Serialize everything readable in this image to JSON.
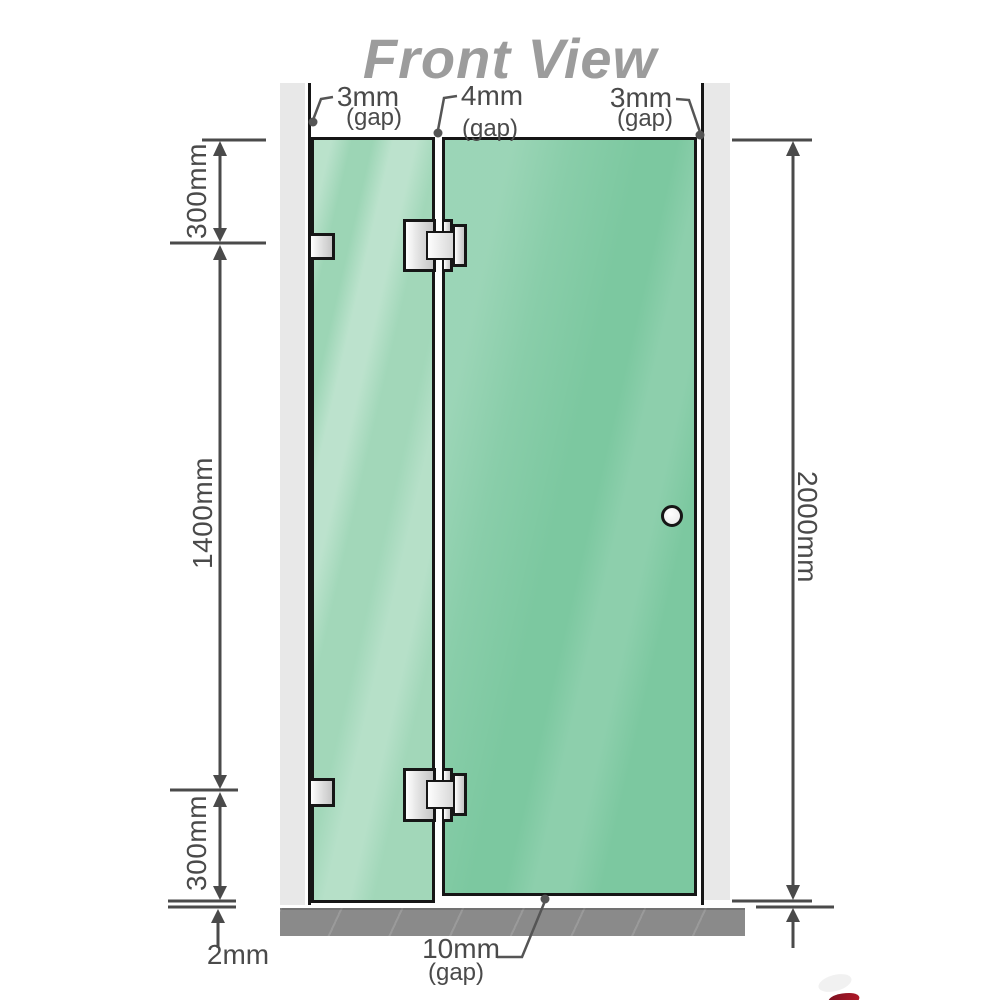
{
  "title": "Front View",
  "colors": {
    "glass_fixed": "#9cd5b5",
    "glass_door": "#7cc8a0",
    "wall": "#e8e8e8",
    "floor": "#8a8a8a",
    "line": "#4a4a4a",
    "leader": "#555555",
    "edge": "#161616",
    "title_gray": "#9c9c9c",
    "accent_red": "#b01828"
  },
  "labels": {
    "gap_top_left": {
      "value": "3mm",
      "note": "(gap)"
    },
    "gap_top_middle": {
      "value": "4mm",
      "note": "(gap)"
    },
    "gap_top_right": {
      "value": "3mm",
      "note": "(gap)"
    },
    "gap_bottom": {
      "value": "10mm",
      "note": "(gap)"
    },
    "floor_clearance": "2mm",
    "left_top_height": "300mm",
    "left_middle_height": "1400mm",
    "left_bottom_height": "300mm",
    "total_height": "2000mm"
  }
}
